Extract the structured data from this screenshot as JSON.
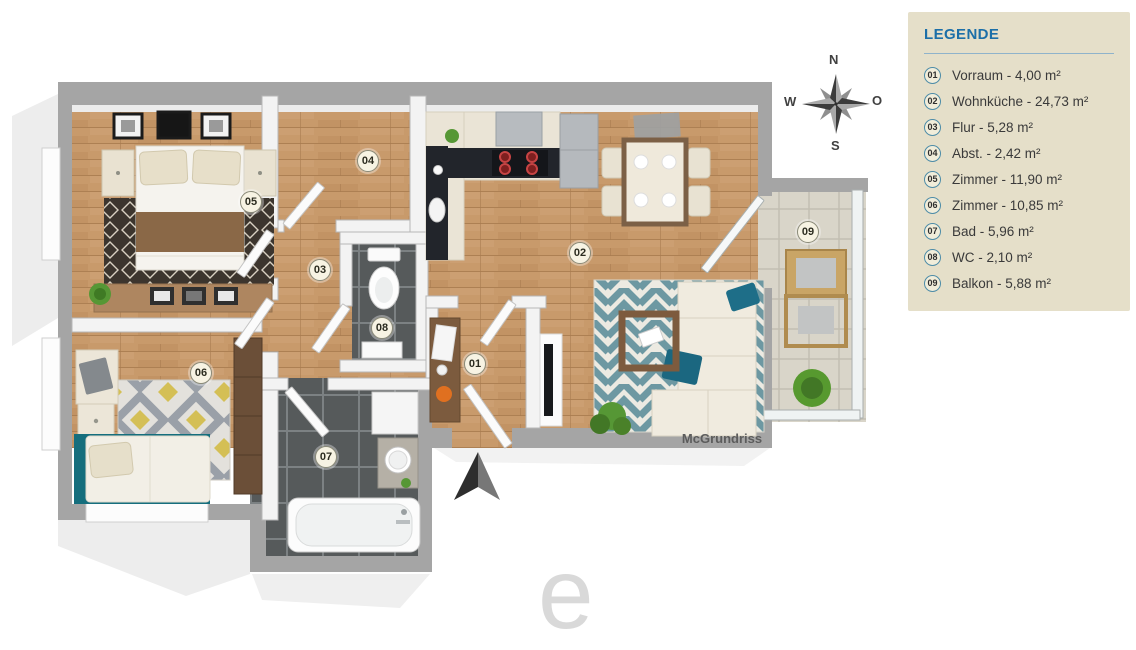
{
  "legend": {
    "title": "LEGENDE",
    "items": [
      {
        "number": "01",
        "label": "Vorraum - 4,00 m²"
      },
      {
        "number": "02",
        "label": "Wohnküche - 24,73 m²"
      },
      {
        "number": "03",
        "label": "Flur - 5,28 m²"
      },
      {
        "number": "04",
        "label": "Abst. - 2,42 m²"
      },
      {
        "number": "05",
        "label": "Zimmer - 11,90 m²"
      },
      {
        "number": "06",
        "label": "Zimmer - 10,85 m²"
      },
      {
        "number": "07",
        "label": "Bad - 5,96 m²"
      },
      {
        "number": "08",
        "label": "WC - 2,10 m²"
      },
      {
        "number": "09",
        "label": "Balkon - 5,88 m²"
      }
    ]
  },
  "compass": {
    "north": "N",
    "south": "S",
    "west": "W",
    "east": "O"
  },
  "plan": {
    "wall_label": "McGrundriss",
    "badges": [
      {
        "number": "01"
      },
      {
        "number": "02"
      },
      {
        "number": "03"
      },
      {
        "number": "04"
      },
      {
        "number": "05"
      },
      {
        "number": "06"
      },
      {
        "number": "07"
      },
      {
        "number": "08"
      },
      {
        "number": "09"
      }
    ]
  },
  "watermark": {
    "letter": "e"
  },
  "colors": {
    "legend_bg": "#e5dfc9",
    "accent_blue": "#1c6fa8",
    "wood_floor": "#c89a6b",
    "rug_teal": "#6d98a2",
    "rug_yellow": "#d4bf55",
    "tile_dark": "#565a5b",
    "tile_light": "#d9d5c9",
    "wall_gray": "#a5a5a5",
    "bed_teal": "#156e7d"
  }
}
